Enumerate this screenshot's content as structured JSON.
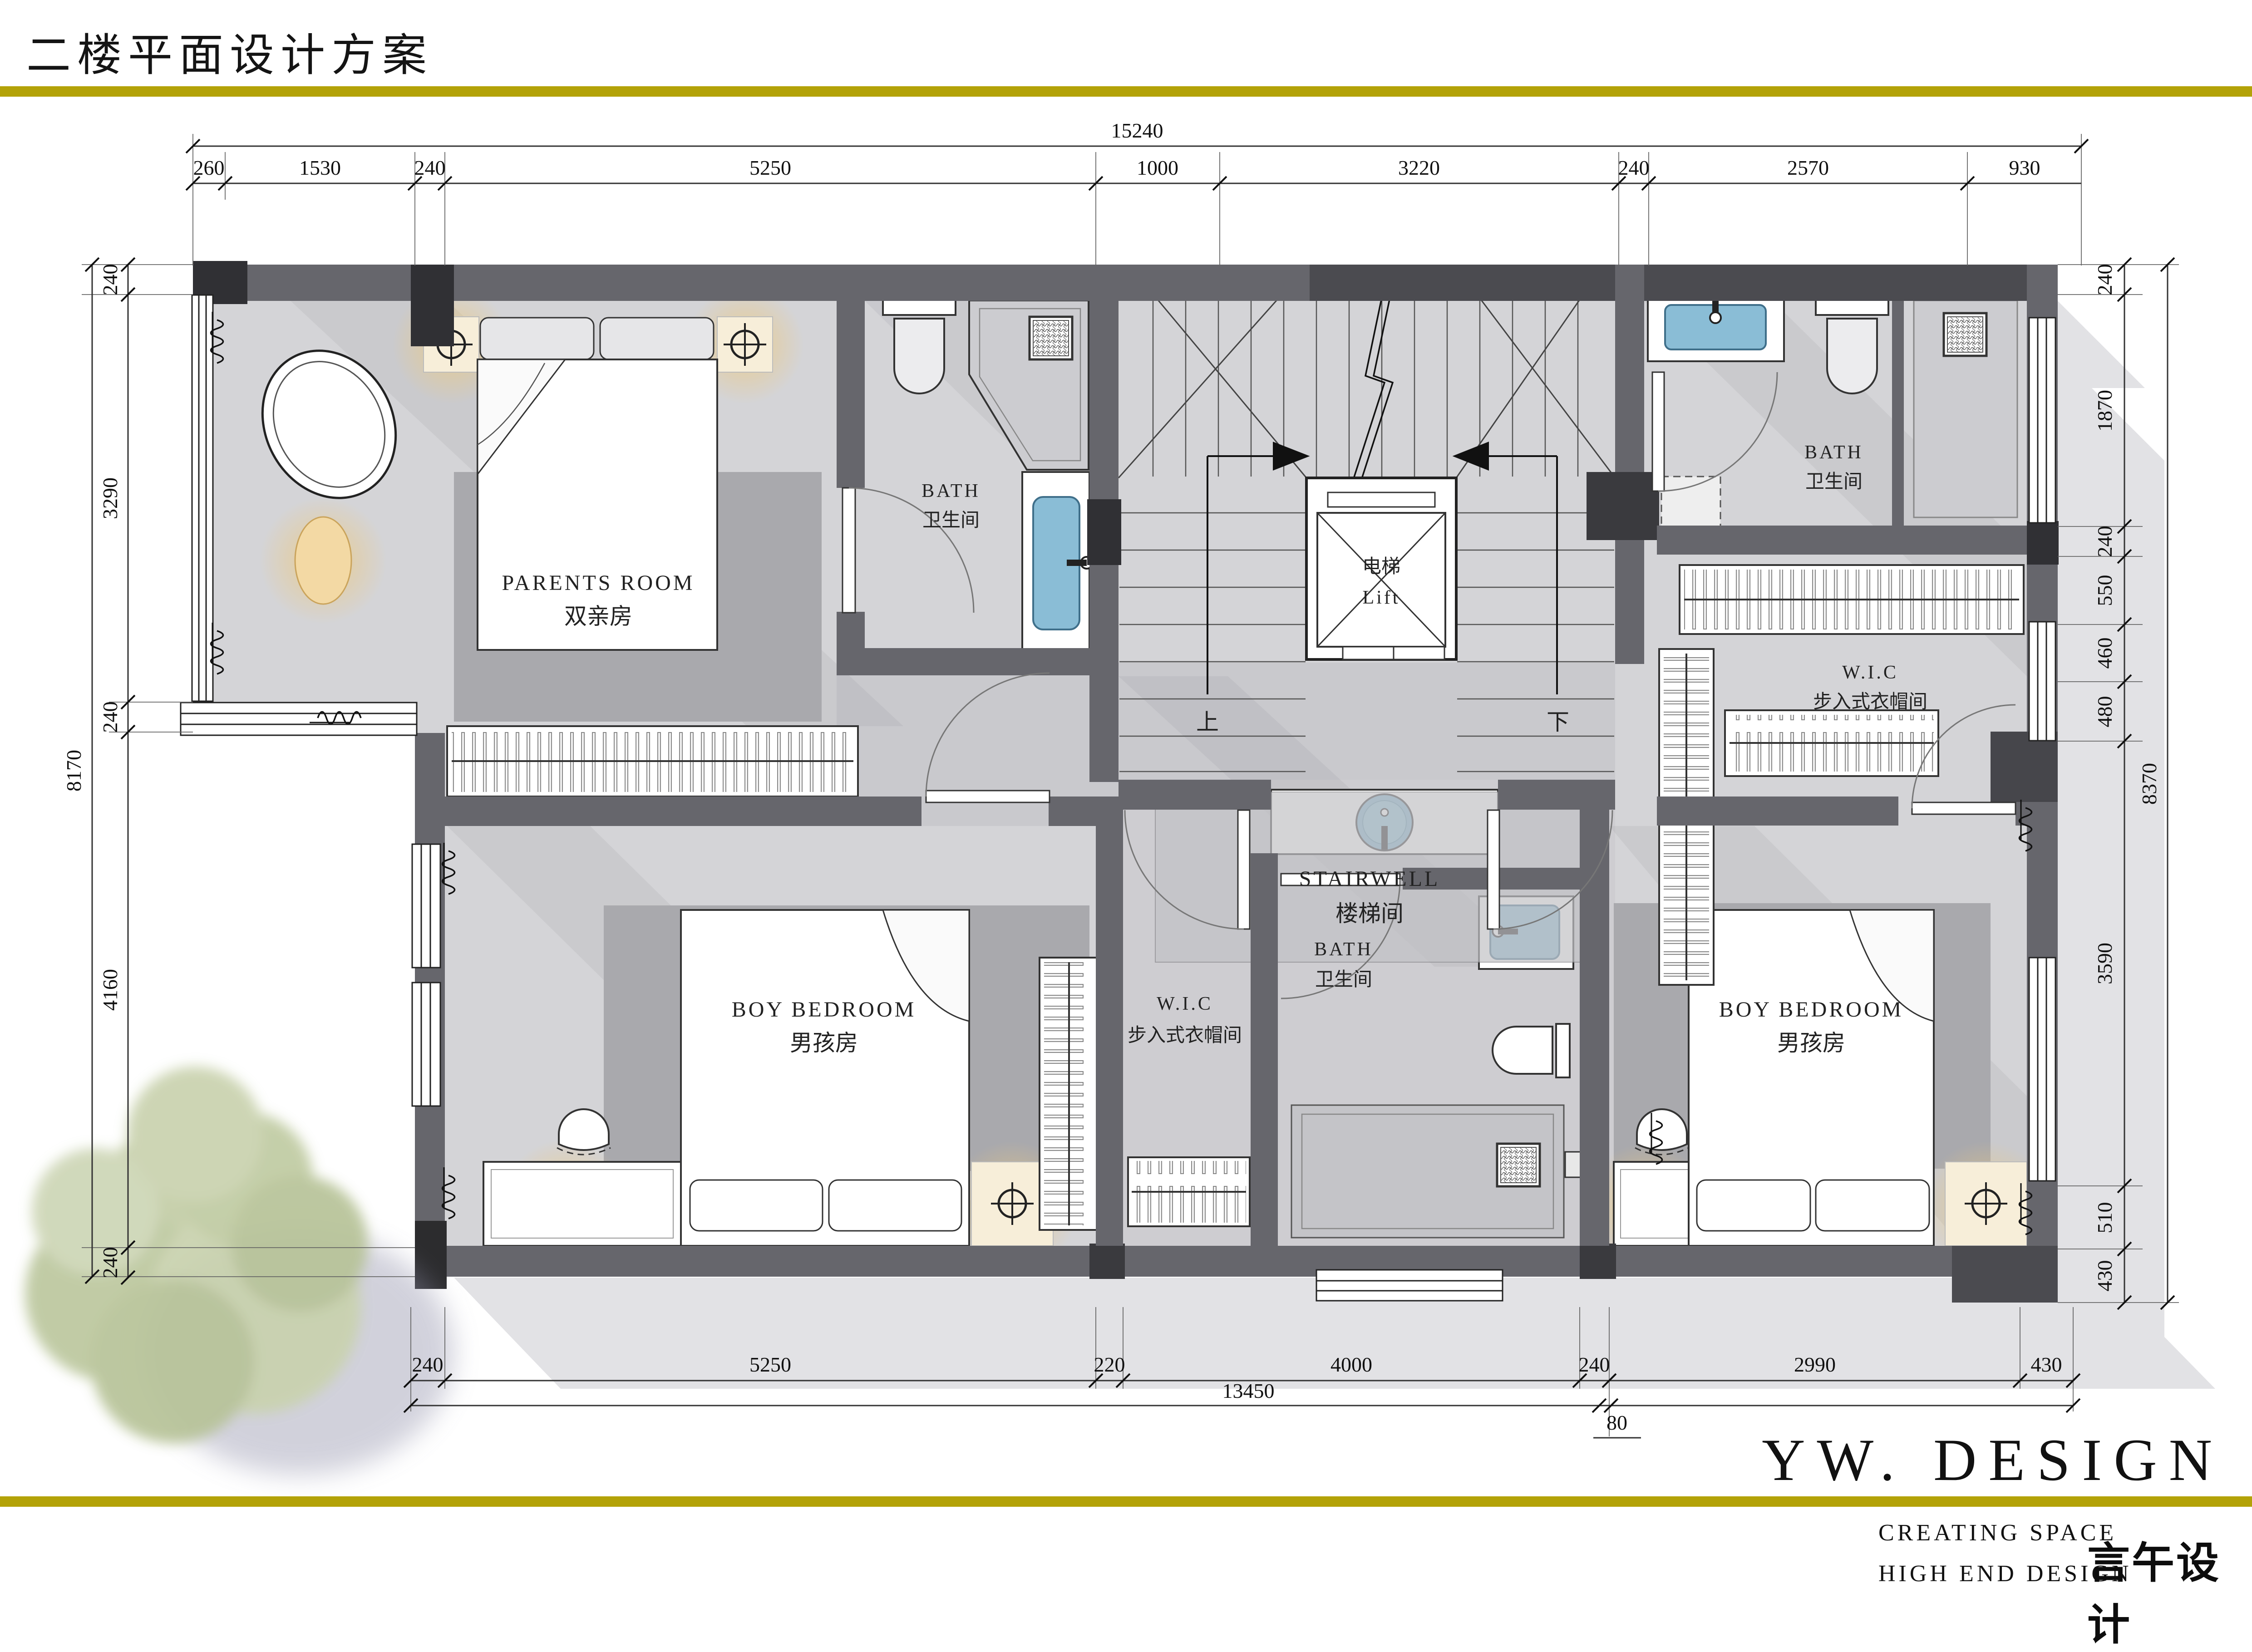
{
  "title": "二楼平面设计方案",
  "rooms": {
    "parents": {
      "en": "PARENTS  ROOM",
      "cn": "双亲房"
    },
    "bath1": {
      "en": "BATH",
      "cn": "卫生间"
    },
    "bath2": {
      "en": "BATH",
      "cn": "卫生间"
    },
    "bath3": {
      "en": "BATH",
      "cn": "卫生间"
    },
    "stairwell": {
      "en": "STAIRWELL",
      "cn": "楼梯间"
    },
    "lift": {
      "cn": "电梯",
      "en": "Lift"
    },
    "wic1": {
      "en": "W.I.C",
      "cn": "步入式衣帽间"
    },
    "wic2": {
      "en": "W.I.C",
      "cn": "步入式衣帽间"
    },
    "boy1": {
      "en": "BOY  BEDROOM",
      "cn": "男孩房"
    },
    "boy2": {
      "en": "BOY  BEDROOM",
      "cn": "男孩房"
    },
    "stair_up": "上",
    "stair_down": "下"
  },
  "dimensions": {
    "top_total": "15240",
    "top": [
      "260",
      "1530",
      "240",
      "5250",
      "1000",
      "3220",
      "240",
      "2570",
      "930"
    ],
    "left_total": "8170",
    "left": [
      "240",
      "3290",
      "240",
      "4160",
      "240"
    ],
    "right_total": "8370",
    "right": [
      "240",
      "1870",
      "240",
      "550",
      "460",
      "480",
      "3590",
      "510",
      "430"
    ],
    "bottom": [
      "240",
      "5250",
      "220",
      "4000",
      "240",
      "2990",
      "430"
    ],
    "bottom_total": "13450",
    "bottom_extra": "80"
  },
  "brand": {
    "logo": "YW. DESIGN",
    "tagline1": "CREATING  SPACE",
    "tagline2": "HIGH  END  DESIGN",
    "cn": "言午设计"
  },
  "colors": {
    "accent_gold": "#b3a208",
    "wall_gray": "#66666c",
    "wall_dark": "#46464b",
    "wall_darkest": "#303034",
    "floor": "#d4d4d7",
    "hall_floor": "#c6c6ca",
    "rug": "#a9a9ad",
    "water_blue": "#8abdd6",
    "glow_orange": "#e8a93d",
    "tree_green": "#c3cda6",
    "tree_shadow": "#8e8ea8"
  }
}
